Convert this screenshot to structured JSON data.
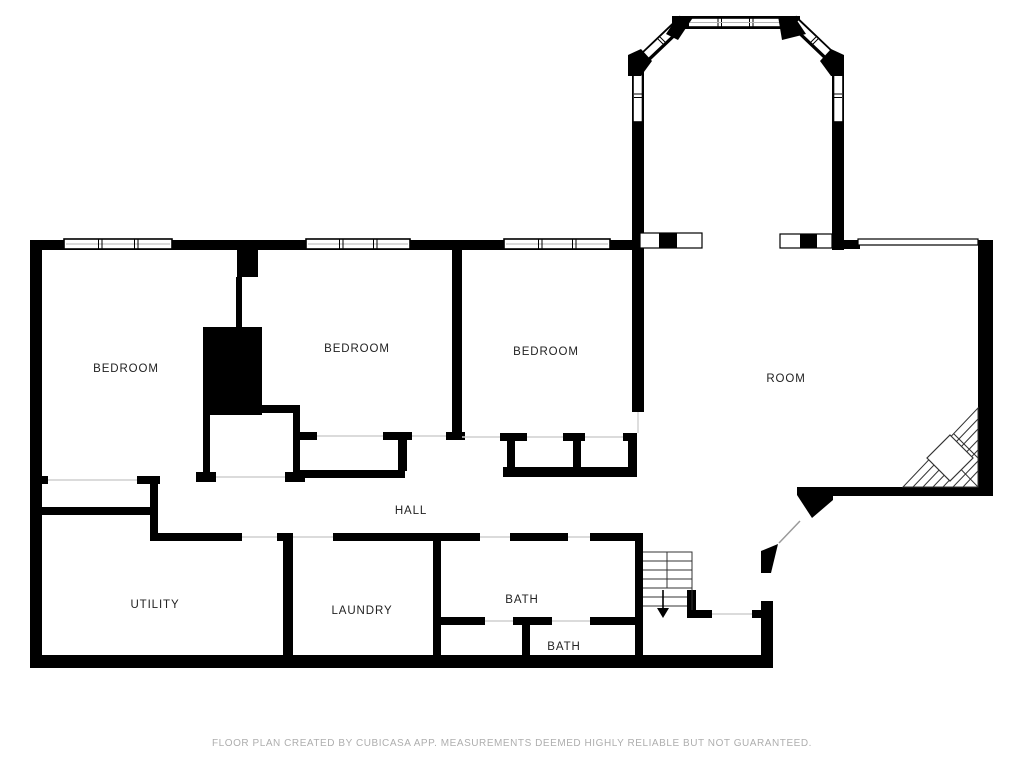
{
  "floor_plan": {
    "title": "Basement floor plan",
    "rooms": [
      {
        "id": "bedroom-1",
        "label": "BEDROOM"
      },
      {
        "id": "bedroom-2",
        "label": "BEDROOM"
      },
      {
        "id": "bedroom-3",
        "label": "BEDROOM"
      },
      {
        "id": "room",
        "label": "ROOM"
      },
      {
        "id": "hall",
        "label": "HALL"
      },
      {
        "id": "utility",
        "label": "UTILITY"
      },
      {
        "id": "laundry",
        "label": "LAUNDRY"
      },
      {
        "id": "bath-1",
        "label": "BATH"
      },
      {
        "id": "bath-2",
        "label": "BATH"
      }
    ],
    "footer": {
      "disclaimer": "FLOOR PLAN CREATED BY CUBICASA APP. MEASUREMENTS DEEMED HIGHLY RELIABLE BUT NOT GUARANTEED."
    },
    "colors": {
      "wall": "#000000",
      "label": "#222222",
      "disclaimer": "#aeaeae"
    }
  }
}
